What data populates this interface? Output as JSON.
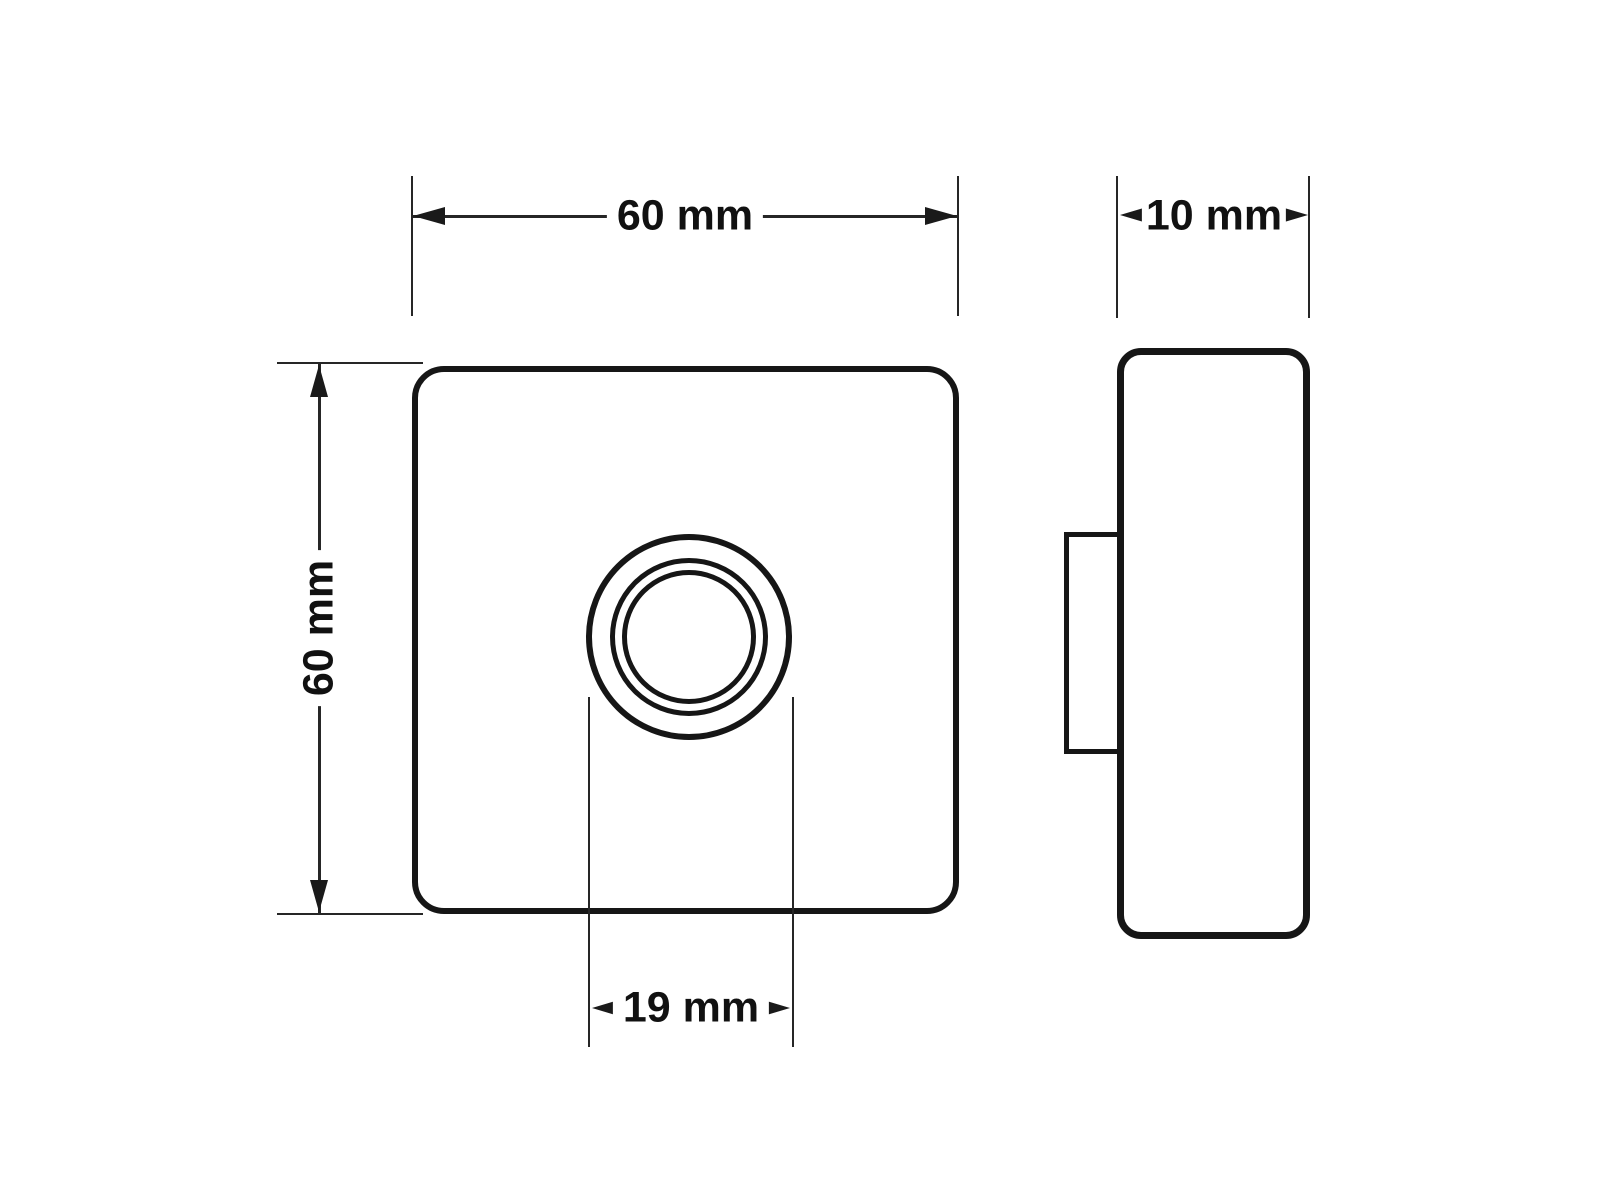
{
  "page": {
    "background": "#ffffff",
    "ink_color": "#161616",
    "thin_line_color": "#262626",
    "text_color": "#111111"
  },
  "diagram": {
    "type": "technical-drawing",
    "views": {
      "front": {
        "width_dim": "60 mm",
        "height_dim": "60 mm",
        "button_diameter_dim": "19 mm"
      },
      "side": {
        "depth_dim": "10 mm"
      }
    }
  }
}
